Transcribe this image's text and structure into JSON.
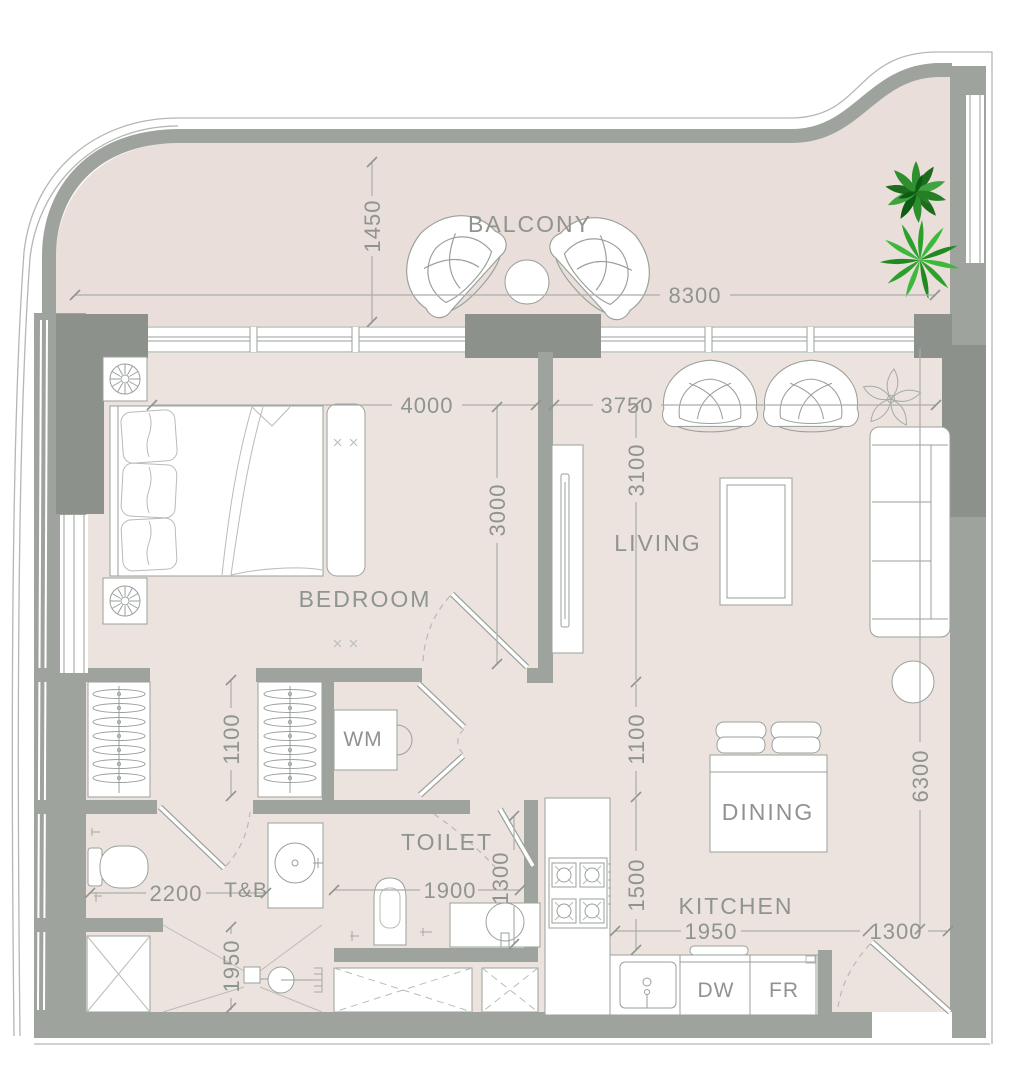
{
  "plan_title": "apartment-unit-floor-plan",
  "rooms": {
    "balcony": "BALCONY",
    "bedroom": "BEDROOM",
    "living": "LIVING",
    "dining": "DINING",
    "kitchen": "KITCHEN",
    "toilet": "TOILET",
    "tnb": "T&B"
  },
  "appliances": {
    "wm": "WM",
    "dw": "DW",
    "fr": "FR"
  },
  "dimensions_mm": {
    "balcony_depth": "1450",
    "balcony_width": "8300",
    "bedroom_width": "4000",
    "bedroom_depth": "3000",
    "living_width": "3750",
    "living_depth": "3100",
    "hall_depth": "1100",
    "wardrobe_aisle": "1100",
    "kitchen_depth": "1500",
    "side_total_depth": "6300",
    "kitchen_width": "1950",
    "entry_width": "1300",
    "tnb_width": "2200",
    "shower_depth": "1950",
    "toilet_width": "1900",
    "toilet_depth": "1300"
  },
  "colors": {
    "floor_main": "#ece3df",
    "floor_balcony": "#e9ded9",
    "wall": "#9ea39e",
    "column": "#8c918c",
    "text": "#8f948f",
    "plant_dark_green": "#1d6b1d",
    "plant_light_green": "#3cb83c"
  }
}
